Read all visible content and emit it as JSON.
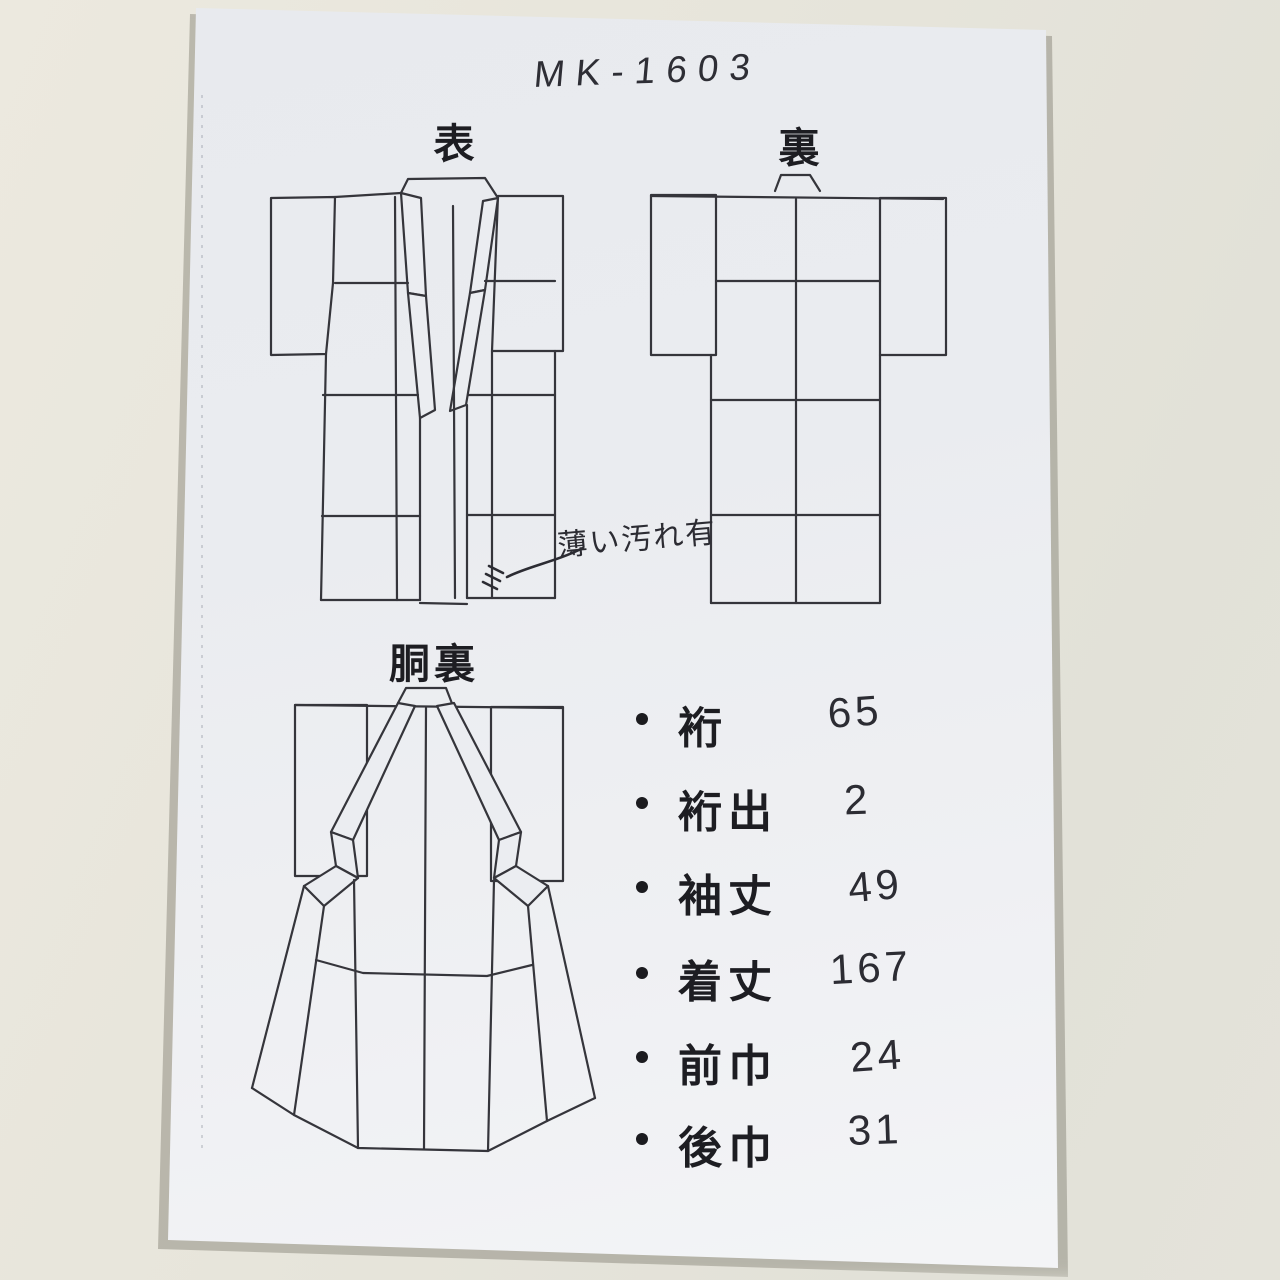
{
  "page": {
    "code": "MK-1603",
    "diagrams": {
      "front_label": "表",
      "back_label": "裏",
      "lining_label": "胴裏"
    },
    "annotation": {
      "text": "薄い汚れ有"
    },
    "measurements": [
      {
        "label": "裄",
        "value": "65"
      },
      {
        "label": "裄出",
        "value": "2"
      },
      {
        "label": "袖丈",
        "value": "49"
      },
      {
        "label": "着丈",
        "value": "167"
      },
      {
        "label": "前巾",
        "value": "24"
      },
      {
        "label": "後巾",
        "value": "31"
      }
    ],
    "colors": {
      "ink": "#35353b",
      "print_text": "#1d1d22",
      "handwriting": "#2c2c33",
      "paper": "#edeff3",
      "desk": "#e6e4da"
    }
  }
}
